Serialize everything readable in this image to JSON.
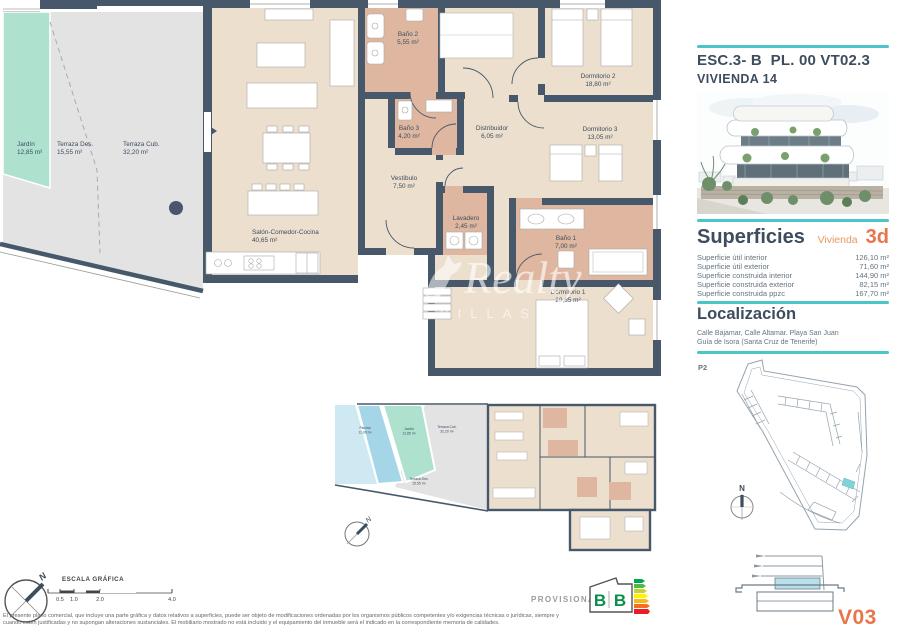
{
  "header": {
    "title": "ESC.3- B  PL. 00 VT02.3",
    "subtitle": "VIVIENDA 14"
  },
  "superficies": {
    "heading": "Superficies",
    "vivienda_label": "Vivienda",
    "vivienda_value": "3d",
    "rows": [
      {
        "label": "Superficie útil interior",
        "value": "126,10 m²"
      },
      {
        "label": "Superficie útil exterior",
        "value": "71,60 m²"
      },
      {
        "label": "Superficie construida interior",
        "value": "144,90 m²"
      },
      {
        "label": "Superficie construida exterior",
        "value": "82,15 m²"
      },
      {
        "label": "Superficie construida ppzc",
        "value": "167,70 m²"
      }
    ]
  },
  "localizacion": {
    "heading": "Localización",
    "address1": "Calle Bajamar, Calle Altamar. Playa San Juan",
    "address2": "Guía de Isora (Santa Cruz de Tenerife)"
  },
  "site_plan": {
    "label": "P2"
  },
  "compass_n": "N",
  "version": "V03",
  "stamp": "PROVISIONAL",
  "energy_label": {
    "letters": [
      "B",
      "B"
    ]
  },
  "scale_bar": {
    "title": "ESCALA GRÁFICA",
    "ticks": [
      "0.5",
      "1.0",
      "2.0",
      "4.0"
    ]
  },
  "watermark": {
    "name": "Realty",
    "sub": "VILLAS"
  },
  "disclaimer": {
    "line1": "El presente plano comercial, que incluye una parte gráfica y datos relativos a superficies, puede ser objeto de modificaciones ordenadas por los organismos públicos competentes y/o exigencias técnicas o jurídicas, siempre y",
    "line2": "cuando estén justificadas y no supongan alteraciones sustanciales. El mobiliario mostrado no está incluido y el equipamiento del inmueble será el indicado en la correspondiente memoria de calidades."
  },
  "floor_plan": {
    "rooms": [
      {
        "name": "Jardín",
        "area": "12,85 m²",
        "x": 17,
        "y": 146,
        "anchor": "start"
      },
      {
        "name": "Terraza Des.",
        "area": "15,55 m²",
        "x": 57,
        "y": 146,
        "anchor": "start"
      },
      {
        "name": "Terraza Cub.",
        "area": "32,20 m²",
        "x": 123,
        "y": 146,
        "anchor": "start"
      },
      {
        "name": "Salón-Comedor-Cocina",
        "area": "40,65 m²",
        "x": 252,
        "y": 234,
        "anchor": "start"
      },
      {
        "name": "Baño 2",
        "area": "5,55 m²",
        "x": 408,
        "y": 36,
        "anchor": "middle"
      },
      {
        "name": "Baño 3",
        "area": "4,20 m²",
        "x": 409,
        "y": 130,
        "anchor": "middle"
      },
      {
        "name": "Distribuidor",
        "area": "6,05 m²",
        "x": 492,
        "y": 130,
        "anchor": "middle"
      },
      {
        "name": "Vestíbulo",
        "area": "7,50 m²",
        "x": 404,
        "y": 180,
        "anchor": "middle"
      },
      {
        "name": "Lavadero",
        "area": "2,45 m²",
        "x": 466,
        "y": 220,
        "anchor": "middle"
      },
      {
        "name": "Dormitorio 2",
        "area": "18,80 m²",
        "x": 598,
        "y": 78,
        "anchor": "middle"
      },
      {
        "name": "Dormitorio 3",
        "area": "13,05 m²",
        "x": 600,
        "y": 131,
        "anchor": "middle"
      },
      {
        "name": "Baño 1",
        "area": "7,00 m²",
        "x": 566,
        "y": 240,
        "anchor": "middle"
      },
      {
        "name": "Dormitorio 1",
        "area": "20,85 m²",
        "x": 568,
        "y": 294,
        "anchor": "middle"
      }
    ]
  },
  "mini_plan": {
    "rooms": [
      {
        "name": "Piscina",
        "area": "11,00 m²",
        "x": 40,
        "y": 37
      },
      {
        "name": "Jardín",
        "area": "12,85 m²",
        "x": 84,
        "y": 38
      },
      {
        "name": "Terraza Cub.",
        "area": "32,20 m²",
        "x": 122,
        "y": 36
      },
      {
        "name": "Terraza Des.",
        "area": "15,55 m²",
        "x": 94,
        "y": 88
      }
    ]
  },
  "colors": {
    "accent_teal": "#4cc5c9",
    "accent_orange": "#e8764b",
    "wall": "#47586a",
    "interior": "#ecdfce",
    "bathroom": "#dfb7a0",
    "terrace": "#e3e3e4",
    "garden": "#aee2cf",
    "pool": "#a5d6e8",
    "text_dark": "#3d4d5e",
    "text_gray": "#64747f"
  }
}
